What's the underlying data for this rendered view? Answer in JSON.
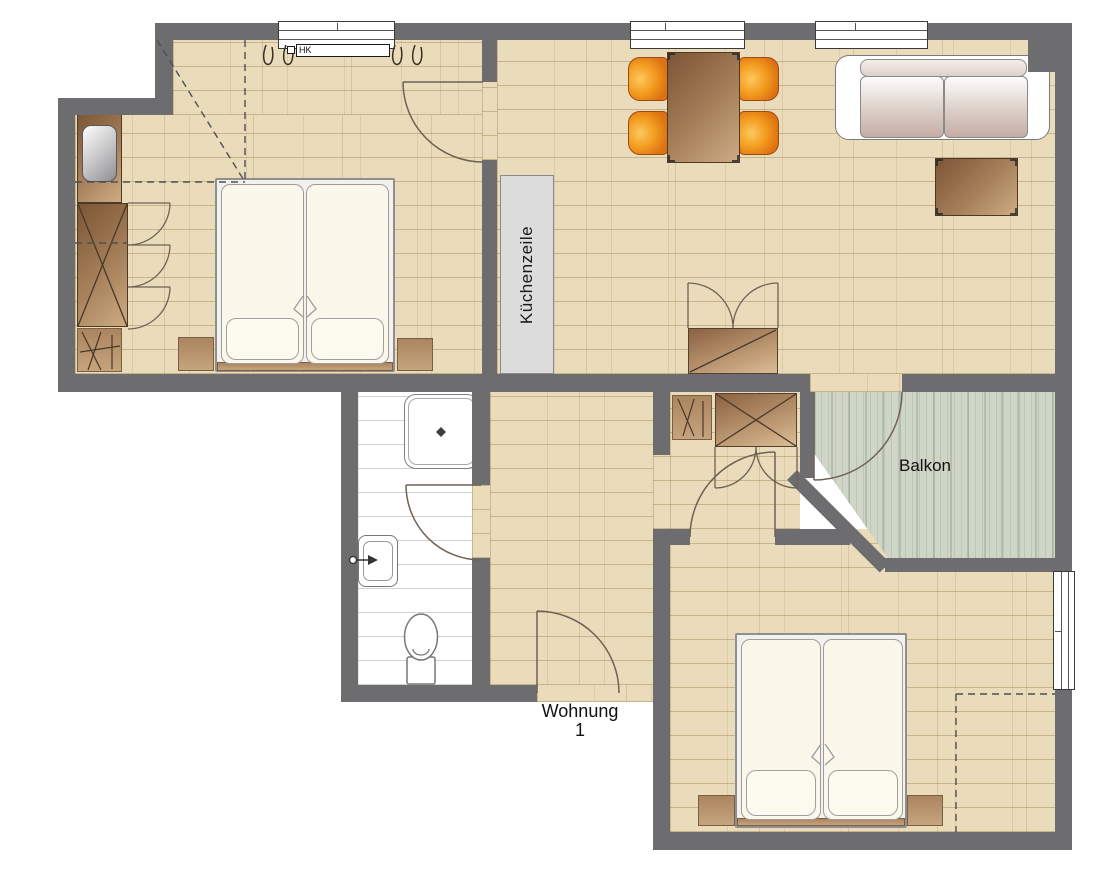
{
  "labels": {
    "kitchen_unit": "Küchenzeile",
    "balcony": "Balkon",
    "apartment_name": "Wohnung",
    "apartment_number": "1",
    "radiator": "HK"
  },
  "colors": {
    "wall": "#6d6d70",
    "wood_floor": "#eadcba",
    "balcony_floor": "#cfd6c8",
    "bathroom_floor": "#ffffff",
    "kitchen_unit": "#dcdcdc",
    "chair_orange": "#f29a1e",
    "furniture_brown": "#a5805a"
  }
}
